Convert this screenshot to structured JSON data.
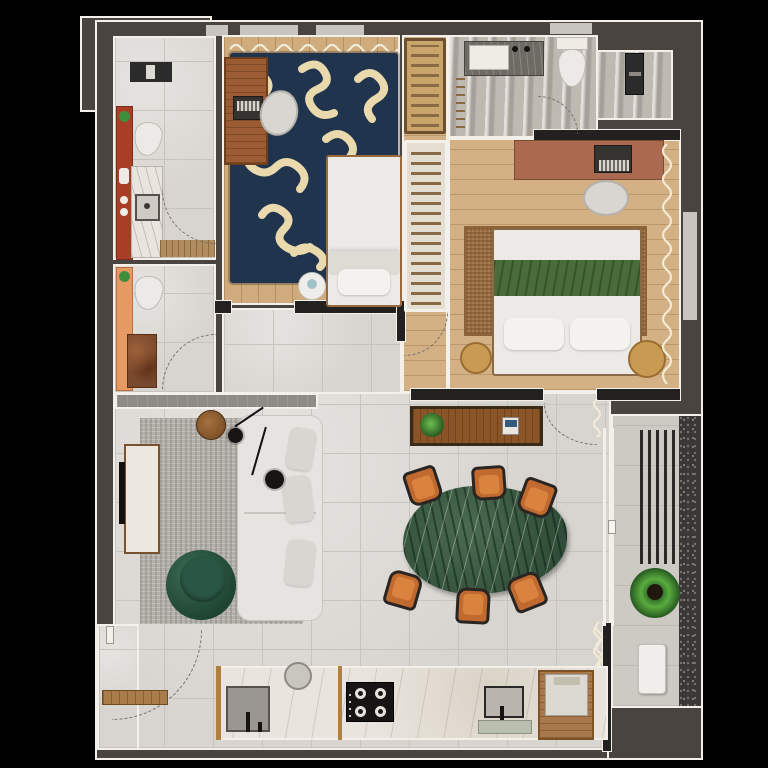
{
  "title": "apartment-floor-plan-top-view",
  "palette": {
    "bg": "#000000",
    "mass": "#494440",
    "wallDark": "#232120",
    "outline": "#f3f0ea",
    "windowSlit": "#c8c4bf",
    "tile": "#d8d5d0",
    "tileLine": "#c7c4be",
    "tileBalcony": "#cdc9c3",
    "marbleBath": "#beb9b1",
    "woodFloor": "#d0ab7e",
    "woodFloor2": "#d3b185",
    "navyRug": "#20344e",
    "squiggle": "#ead9ac",
    "juteRug": "#a87c50",
    "grayRug": "#b3afa9",
    "sofa": "#e6e4e0",
    "cushion": "#d9d6d1",
    "pouf": "#2a5744",
    "poufDark": "#1d4231",
    "marbleTable": "#3d5b46",
    "chairOrange": "#c06a30",
    "chairFrame": "#2a2523",
    "deskWood": "#9c5c33",
    "deskTerracotta": "#a96a4f",
    "sideboard": "#8a5427",
    "vanityRed": "#a83e26",
    "vanityPeach": "#e59a64",
    "counterMarble": "#e9e5de",
    "counterPanel": "#9a9691",
    "stoneLedge": "#8f8b86",
    "speckle": "#3a3836",
    "louver": "#2c2a28",
    "plant": "#3f8f3a",
    "plantDark": "#1e4d1c",
    "bedWhite": "#eceae6",
    "blanketGreen": "#4a6b3a",
    "stoolWood": "#c99a52",
    "rackSlat": "#8a6a45",
    "curtain": "#f3ead6",
    "arcColor": "#76716c",
    "applianceDark": "#2b2b2b"
  },
  "rooms": [
    {
      "id": "ensuite-bathroom",
      "features": [
        "washer",
        "red-vanity",
        "toilet",
        "marble-sink-counter",
        "wood-shower-mat",
        "door-swing"
      ]
    },
    {
      "id": "guest-bathroom",
      "features": [
        "peach-vanity",
        "toilet",
        "stone-shower",
        "door-swing"
      ]
    },
    {
      "id": "bedroom-1",
      "features": [
        "window-curtain",
        "navy-squiggle-rug",
        "wood-desk",
        "laptop",
        "chair",
        "single-bed",
        "round-side-table"
      ]
    },
    {
      "id": "closet-corridor",
      "features": [
        "wardrobe-rack-wood",
        "wardrobe-rack-white",
        "door-swing"
      ]
    },
    {
      "id": "bathroom-2",
      "features": [
        "dark-counter-sink",
        "toilet",
        "towel-ladder",
        "tall-cabinet",
        "door-swing"
      ]
    },
    {
      "id": "bedroom-2",
      "features": [
        "terracotta-desk",
        "laptop",
        "chair",
        "jute-rug",
        "double-bed-green-blanket",
        "two-round-stools",
        "window-curtain",
        "door-swing"
      ]
    },
    {
      "id": "living-room",
      "features": [
        "gray-rug",
        "tv-console",
        "tv",
        "l-shaped-sofa",
        "green-pouf",
        "round-wood-table",
        "two-pendant-lamps",
        "half-wall-ledge"
      ]
    },
    {
      "id": "dining-area",
      "features": [
        "wood-sideboard",
        "plant",
        "books",
        "green-marble-table",
        "six-orange-chairs"
      ]
    },
    {
      "id": "balcony",
      "features": [
        "louver-screen",
        "plant",
        "white-bench",
        "granite-strip",
        "sliding-door",
        "curtains"
      ]
    },
    {
      "id": "kitchen",
      "features": [
        "marble-counter",
        "gray-panel-sink",
        "faucet",
        "round-sink",
        "cooktop-4-burners",
        "second-sink",
        "dish-tray",
        "wood-cabinet-appliance",
        "entry-door-swing",
        "entry-bench"
      ]
    }
  ]
}
